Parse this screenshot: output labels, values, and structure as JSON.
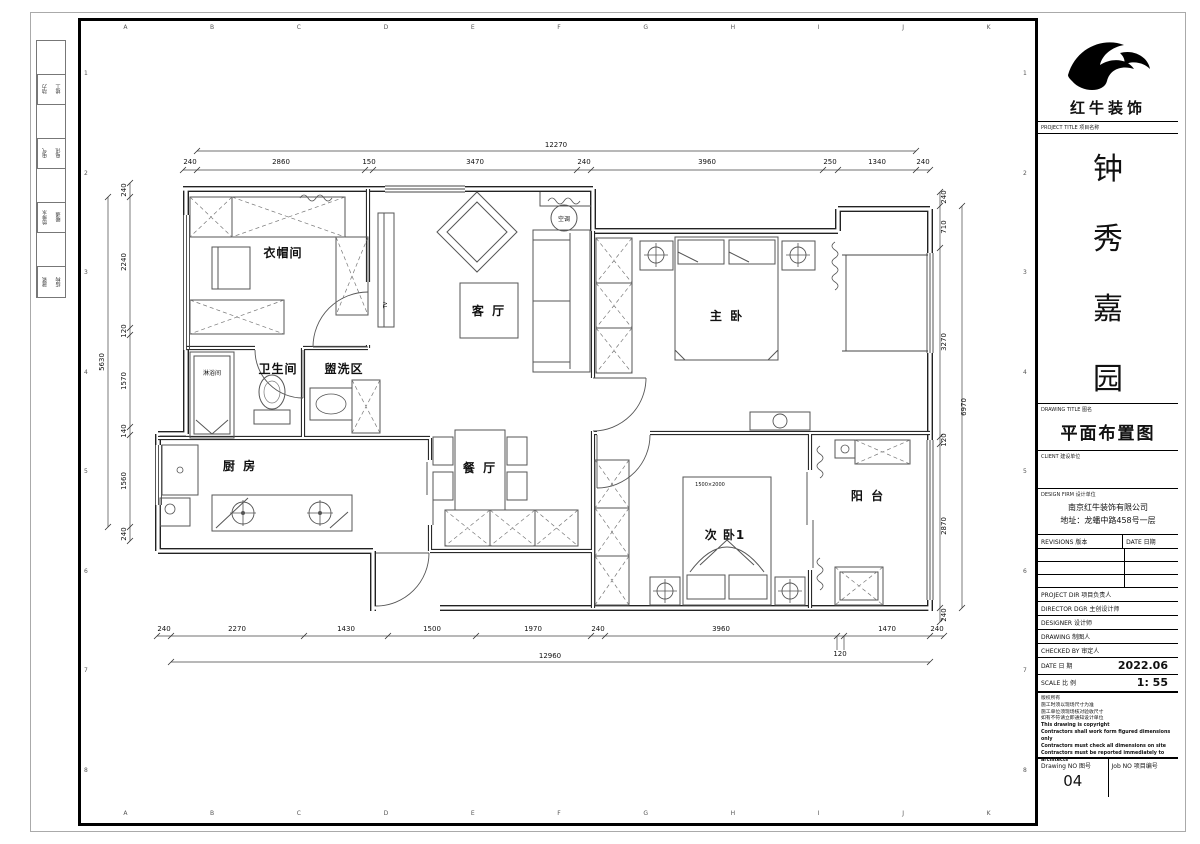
{
  "grid": {
    "letters": [
      "A",
      "B",
      "C",
      "D",
      "E",
      "F",
      "G",
      "H",
      "I",
      "J",
      "K"
    ],
    "numbers": [
      "1",
      "2",
      "3",
      "4",
      "5",
      "6",
      "7",
      "8"
    ]
  },
  "disciplines": [
    {
      "a": "动力",
      "b": "竣工"
    },
    {
      "a": "电气",
      "b": "电讯"
    },
    {
      "a": "给排水",
      "b": "暖通"
    },
    {
      "a": "建筑",
      "b": "结构"
    }
  ],
  "plan": {
    "labels": {
      "cloakroom": "衣帽间",
      "bathroom": "卫生间",
      "shower": "淋浴间",
      "wash_area": "盥洗区",
      "kitchen": "厨 房",
      "living": "客 厅",
      "dining": "餐 厅",
      "master": "主 卧",
      "bedroom2": "次 卧1",
      "balcony": "阳 台",
      "ac": "空调",
      "tv": "TV",
      "bed_size": "1500×2000"
    },
    "dims": {
      "top_total": "12270",
      "top": [
        "240",
        "2860",
        "150",
        "3470",
        "240",
        "3960",
        "250",
        "1340",
        "240"
      ],
      "bottom": [
        "240",
        "2270",
        "1430",
        "1500",
        "1970",
        "240",
        "3960",
        "120",
        "1470",
        "240"
      ],
      "bottom_total": "12960",
      "left": [
        "240",
        "2240",
        "120",
        "1570",
        "140",
        "1560",
        "240"
      ],
      "left_total": "5630",
      "right": [
        "240",
        "710",
        "3270",
        "120",
        "2870",
        "240"
      ],
      "right_total": "6970"
    }
  },
  "titleblock": {
    "brand": "红牛装饰",
    "project_label": "PROJECT TITLE 项目名称",
    "project_chars": [
      "钟",
      "秀",
      "嘉",
      "园"
    ],
    "drawing_label": "DRAWING TITLE 图名",
    "drawing_title": "平面布置图",
    "client_label": "CLIENT 建设单位",
    "firm_label": "DESIGN FIRM 设计单位",
    "firm_name": "南京红牛装饰有限公司",
    "firm_addr": "地址：龙蟠中路458号一层",
    "revisions_label": "REVISIONS 版本",
    "date_col_label": "DATE 日期",
    "project_dir_label": "PROJECT DIR 项目负责人",
    "director_label": "DIRECTOR DGR 主创设计师",
    "designer_label": "DESIGNER 设计师",
    "drawing_by_label": "DRAWING 制图人",
    "checked_label": "CHECKED BY 审定人",
    "date_label": "DATE 日 期",
    "date_value": "2022.06",
    "scale_label": "SCALE 比 例",
    "scale_value": "1: 55",
    "notes": [
      "版权所有",
      "施工时须以现场尺寸为准",
      "施工单位须现场核对验收尺寸",
      "如有不符请立即通知设计单位",
      "This drawing is copyright",
      "Contractors shall work form figured dimensions only",
      "Contractors must check all dimensions on site",
      "Contractors must be reported immediately to architects"
    ],
    "drawing_no_label": "Drawing NO 图号",
    "drawing_no": "04",
    "job_no_label": "Job NO 项目编号"
  }
}
